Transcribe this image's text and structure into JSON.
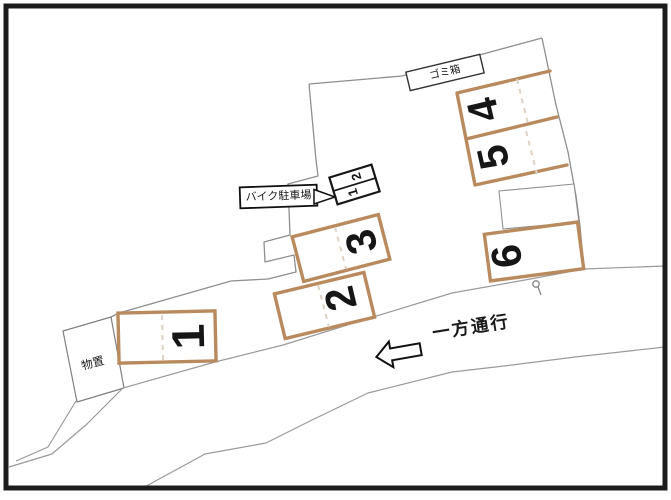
{
  "labels": {
    "trash_box": "ゴミ箱",
    "bike_parking": "バイク駐車場",
    "storage": "物置",
    "one_way": "一方通行"
  },
  "stalls": [
    {
      "label": "1"
    },
    {
      "label": "2"
    },
    {
      "label": "3"
    },
    {
      "label": "4"
    },
    {
      "label": "5"
    },
    {
      "label": "6"
    }
  ],
  "bike_stalls": [
    {
      "label": "1"
    },
    {
      "label": "2"
    }
  ],
  "colors": {
    "stall_border": "#b98a5e",
    "lot_outline": "#8f8f8f",
    "road_line": "#9a9a9a",
    "frame": "#1c1c1c",
    "label_text": "#111111"
  }
}
